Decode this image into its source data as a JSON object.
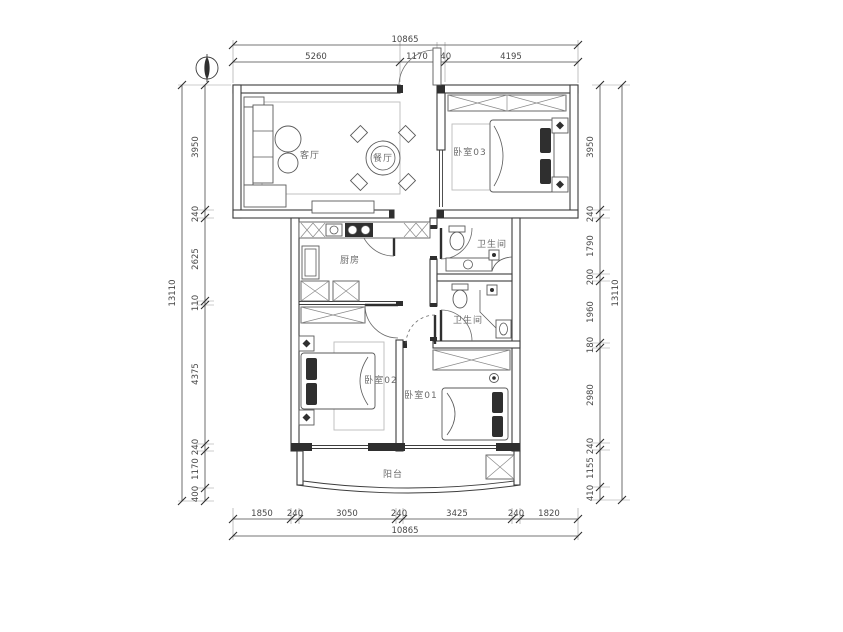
{
  "plan": {
    "type": "apartment-floor-plan",
    "colors": {
      "line": "#3d3d3d",
      "background": "#ffffff",
      "furniture": "#5a5a5a",
      "text": "#6b6b6b"
    }
  },
  "rooms": {
    "living": "客厅",
    "dining": "餐厅",
    "bedroom03": "卧室03",
    "kitchen": "厨房",
    "bathroom_top": "卫生间",
    "bathroom_bottom": "卫生间",
    "bedroom02": "卧室02",
    "bedroom01": "卧室01",
    "balcony": "阳台"
  },
  "dims": {
    "overall_width": "10865",
    "overall_height": "13110",
    "top": [
      "5260",
      "1170",
      "240",
      "4195"
    ],
    "bottom": [
      "1850",
      "240",
      "3050",
      "240",
      "3425",
      "240",
      "1820"
    ],
    "left": [
      "3950",
      "240",
      "2625",
      "110",
      "4375",
      "240",
      "1170",
      "400"
    ],
    "right": [
      "3950",
      "240",
      "1790",
      "200",
      "1960",
      "180",
      "2980",
      "240",
      "1155",
      "410"
    ]
  }
}
